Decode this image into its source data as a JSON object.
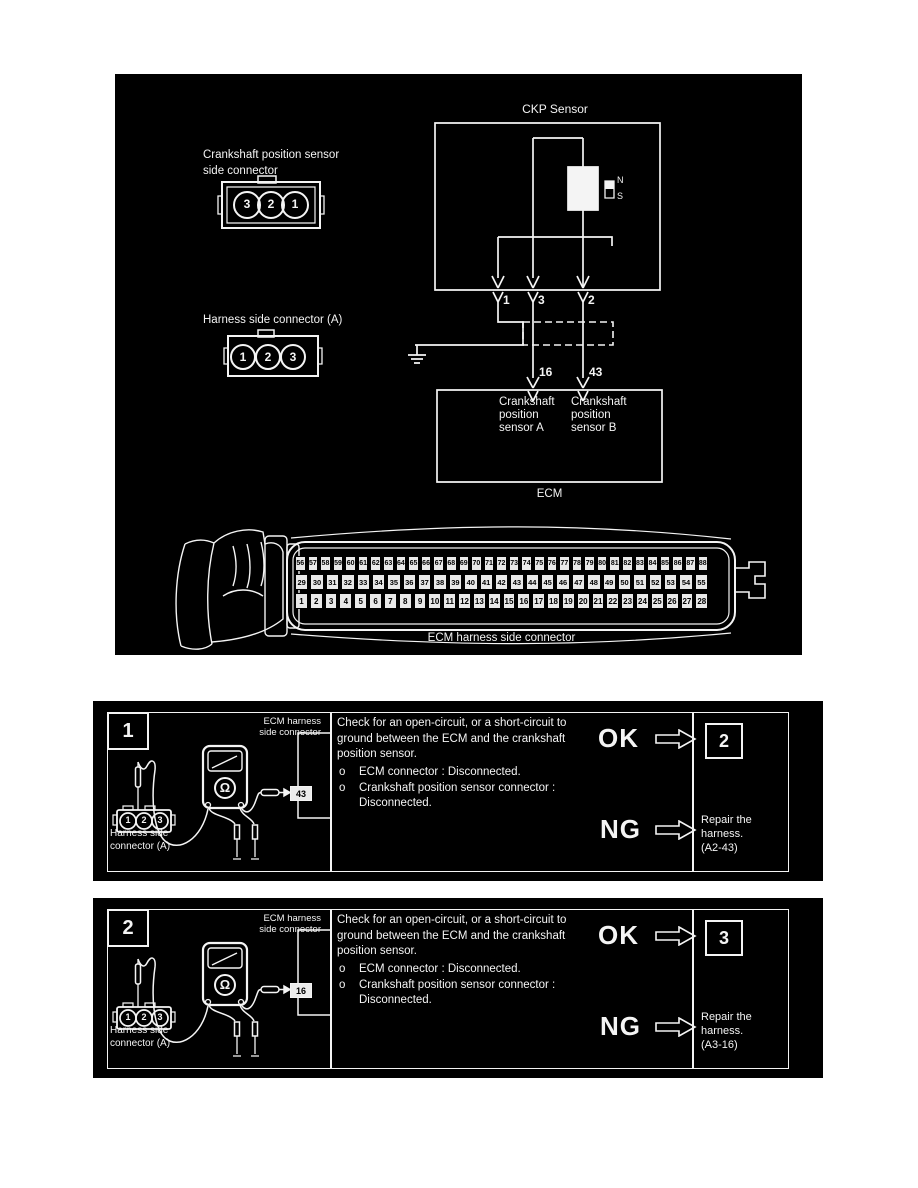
{
  "diagram": {
    "ckp_sensor_label": "CKP Sensor",
    "sensor_connector_label_line1": "Crankshaft position sensor",
    "sensor_connector_label_line2": "side connector",
    "sensor_connector_pins": [
      "3",
      "2",
      "1"
    ],
    "harness_connector_label": "Harness side connector (A)",
    "harness_connector_pins": [
      "1",
      "2",
      "3"
    ],
    "magnet_n": "N",
    "magnet_s": "S",
    "wire_pin_1": "1",
    "wire_pin_3": "3",
    "wire_pin_2": "2",
    "ecm_pin_left": "16",
    "ecm_pin_right": "43",
    "ecm_box_left_line1": "Crankshaft",
    "ecm_box_left_line2": "position",
    "ecm_box_left_line3": "sensor A",
    "ecm_box_right_line1": "Crankshaft",
    "ecm_box_right_line2": "position",
    "ecm_box_right_line3": "sensor B",
    "ecm_label": "ECM",
    "ecm_connector_label": "ECM harness side connector",
    "ecm_rows": {
      "row1": [
        "56",
        "57",
        "58",
        "59",
        "60",
        "61",
        "62",
        "63",
        "64",
        "65",
        "66",
        "67",
        "68",
        "69",
        "70",
        "71",
        "72",
        "73",
        "74",
        "75",
        "76",
        "77",
        "78",
        "79",
        "80",
        "81",
        "82",
        "83",
        "84",
        "85",
        "86",
        "87",
        "88"
      ],
      "row2": [
        "29",
        "30",
        "31",
        "32",
        "33",
        "34",
        "35",
        "36",
        "37",
        "38",
        "39",
        "40",
        "41",
        "42",
        "43",
        "44",
        "45",
        "46",
        "47",
        "48",
        "49",
        "50",
        "51",
        "52",
        "53",
        "54",
        "55"
      ],
      "row3": [
        "1",
        "2",
        "3",
        "4",
        "5",
        "6",
        "7",
        "8",
        "9",
        "10",
        "11",
        "12",
        "13",
        "14",
        "15",
        "16",
        "17",
        "18",
        "19",
        "20",
        "21",
        "22",
        "23",
        "24",
        "25",
        "26",
        "27",
        "28"
      ]
    }
  },
  "steps": [
    {
      "number": "1",
      "ecm_harness_label_line1": "ECM harness",
      "ecm_harness_label_line2": "side connector",
      "pin_tag": "43",
      "harness_label_line1": "Harness side",
      "harness_label_line2": "connector (A)",
      "connector_pins": [
        "1",
        "2",
        "3"
      ],
      "meter_symbol": "Ω",
      "instruction": "Check for an open-circuit, or a short-circuit to ground between the ECM and the crankshaft position sensor.",
      "bullet_marker": "o",
      "bullets": [
        "ECM connector : Disconnected.",
        "Crankshaft position sensor connector : Disconnected."
      ],
      "ok_label": "OK",
      "ok_target": "2",
      "ng_label": "NG",
      "ng_action_line1": "Repair the",
      "ng_action_line2": "harness.",
      "ng_action_line3": "(A2-43)"
    },
    {
      "number": "2",
      "ecm_harness_label_line1": "ECM harness",
      "ecm_harness_label_line2": "side connector",
      "pin_tag": "16",
      "harness_label_line1": "Harness side",
      "harness_label_line2": "connector (A)",
      "connector_pins": [
        "1",
        "2",
        "3"
      ],
      "meter_symbol": "Ω",
      "instruction": "Check for an open-circuit, or a short-circuit to ground between the ECM and the crankshaft position sensor.",
      "bullet_marker": "o",
      "bullets": [
        "ECM connector : Disconnected.",
        "Crankshaft position sensor connector : Disconnected."
      ],
      "ok_label": "OK",
      "ok_target": "3",
      "ng_label": "NG",
      "ng_action_line1": "Repair the",
      "ng_action_line2": "harness.",
      "ng_action_line3": "(A3-16)"
    }
  ]
}
